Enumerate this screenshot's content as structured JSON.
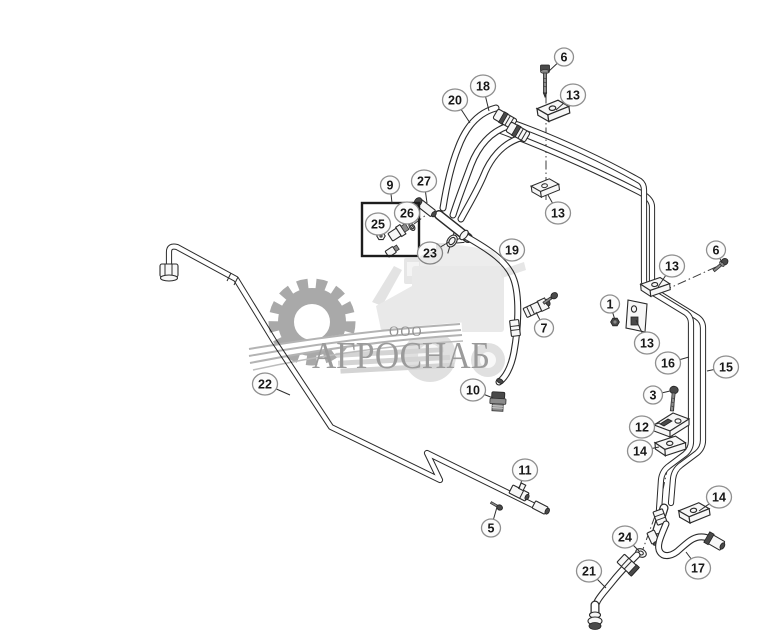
{
  "diagram": {
    "description": "Exploded parts diagram of hydraulic tube and hose assembly with numbered callouts",
    "background": "#ffffff",
    "line_color": "#2b2b2b",
    "callout_fill": "#fcfcfc",
    "callout_border": "#8f8f8f",
    "callout_text_color": "#181818",
    "group_box_callout": "9"
  },
  "watermark": {
    "ooo_text": "ООО",
    "brand_text": "АГРОСНАБ",
    "text_color": "#9b9b9b",
    "gear_color": "#a9a9a9",
    "machine_color": "#e8e8e8"
  },
  "callouts": [
    {
      "label": "6",
      "x": 564,
      "y": 57,
      "leader": [
        548,
        72
      ]
    },
    {
      "label": "18",
      "x": 483,
      "y": 86,
      "leader": [
        489,
        111
      ]
    },
    {
      "label": "13",
      "x": 573,
      "y": 95,
      "leader": [
        556,
        110
      ]
    },
    {
      "label": "20",
      "x": 455,
      "y": 100,
      "leader": [
        470,
        123
      ]
    },
    {
      "label": "9",
      "x": 390,
      "y": 185,
      "leader": [
        392,
        203
      ]
    },
    {
      "label": "27",
      "x": 424,
      "y": 181,
      "leader": [
        427,
        203
      ]
    },
    {
      "label": "13",
      "x": 558,
      "y": 213,
      "leader": [
        548,
        195
      ]
    },
    {
      "label": "25",
      "x": 378,
      "y": 224,
      "leader": [
        381,
        233
      ]
    },
    {
      "label": "26",
      "x": 407,
      "y": 213,
      "leader": [
        409,
        226
      ]
    },
    {
      "label": "23",
      "x": 430,
      "y": 253,
      "leader": [
        449,
        242
      ]
    },
    {
      "label": "19",
      "x": 512,
      "y": 250,
      "leader": null
    },
    {
      "label": "6",
      "x": 716,
      "y": 250,
      "leader": [
        722,
        263
      ]
    },
    {
      "label": "13",
      "x": 672,
      "y": 266,
      "leader": [
        658,
        287
      ]
    },
    {
      "label": "1",
      "x": 610,
      "y": 304,
      "leader": [
        615,
        320
      ]
    },
    {
      "label": "13",
      "x": 647,
      "y": 343,
      "leader": [
        636,
        320
      ]
    },
    {
      "label": "7",
      "x": 544,
      "y": 328,
      "leader": [
        536,
        312
      ]
    },
    {
      "label": "16",
      "x": 668,
      "y": 363,
      "leader": [
        689,
        357
      ]
    },
    {
      "label": "15",
      "x": 726,
      "y": 367,
      "leader": [
        707,
        371
      ]
    },
    {
      "label": "22",
      "x": 265,
      "y": 384,
      "leader": [
        290,
        395
      ]
    },
    {
      "label": "3",
      "x": 653,
      "y": 395,
      "leader": [
        670,
        391
      ]
    },
    {
      "label": "10",
      "x": 473,
      "y": 390,
      "leader": [
        493,
        398
      ]
    },
    {
      "label": "12",
      "x": 642,
      "y": 427,
      "leader": [
        660,
        423
      ]
    },
    {
      "label": "14",
      "x": 640,
      "y": 451,
      "leader": [
        659,
        447
      ]
    },
    {
      "label": "11",
      "x": 525,
      "y": 470,
      "leader": [
        519,
        489
      ]
    },
    {
      "label": "5",
      "x": 491,
      "y": 528,
      "leader": [
        497,
        507
      ]
    },
    {
      "label": "14",
      "x": 719,
      "y": 497,
      "leader": [
        699,
        511
      ]
    },
    {
      "label": "24",
      "x": 625,
      "y": 537,
      "leader": [
        639,
        551
      ]
    },
    {
      "label": "21",
      "x": 589,
      "y": 571,
      "leader": [
        606,
        588
      ]
    },
    {
      "label": "17",
      "x": 698,
      "y": 568,
      "leader": [
        686,
        552
      ]
    }
  ]
}
